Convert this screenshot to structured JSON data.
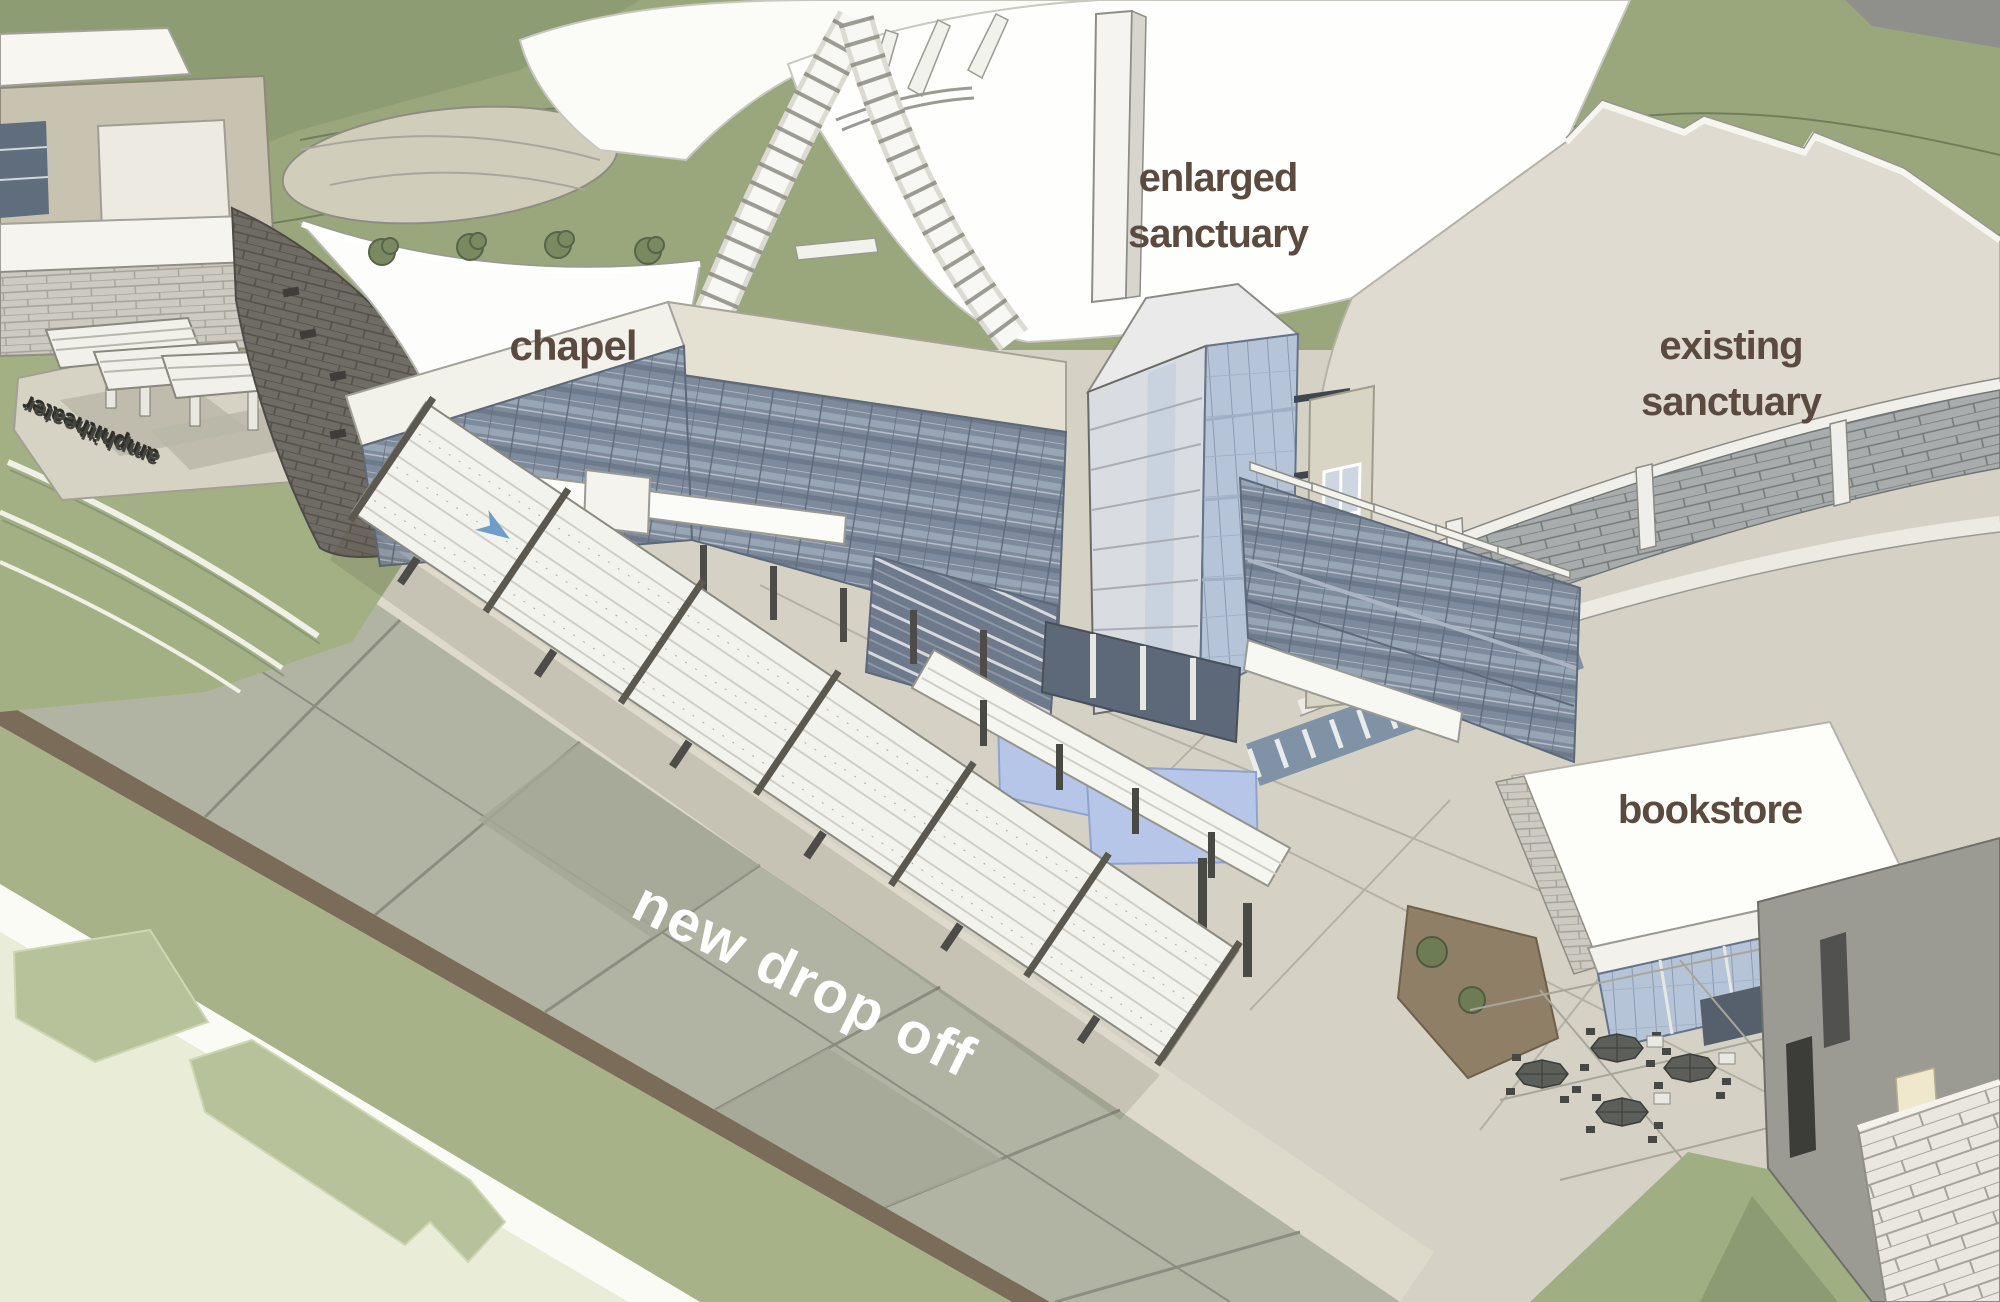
{
  "page": {
    "type": "architectural-rendering",
    "subject": "church campus expansion - aerial massing rendering"
  },
  "labels": {
    "enlarged_sanctuary": {
      "line1": "enlarged",
      "line2": "sanctuary"
    },
    "chapel": {
      "text": "chapel"
    },
    "existing_sanctuary": {
      "line1": "existing",
      "line2": "sanctuary"
    },
    "bookstore": {
      "text": "bookstore"
    },
    "new_drop_off": {
      "text": "new drop off"
    },
    "amphitheater": {
      "text": "amphitheater"
    }
  },
  "colors": {
    "annotation_brown": "#5b4a40",
    "annotation_white": "#ffffff",
    "hills_green": "#9aa77d",
    "lawn_green": "#a3b084",
    "field_pale_green": "#e9ecd7",
    "road_grey_green": "#b2b4a3",
    "plaza_concrete": "#d3d0c3",
    "roof_white": "#fcfcfa",
    "existing_roof_beige": "#dfdbd0",
    "curtain_wall_slate": "#7e8b9d",
    "tower_glass_blue": "#b6c4d8",
    "reflecting_pool_blue": "#b5c6e9",
    "brick_wall_dark": "#6f6b65",
    "stone_band_grey": "#a8acac",
    "umbrella_grey": "#5c5e5a"
  }
}
